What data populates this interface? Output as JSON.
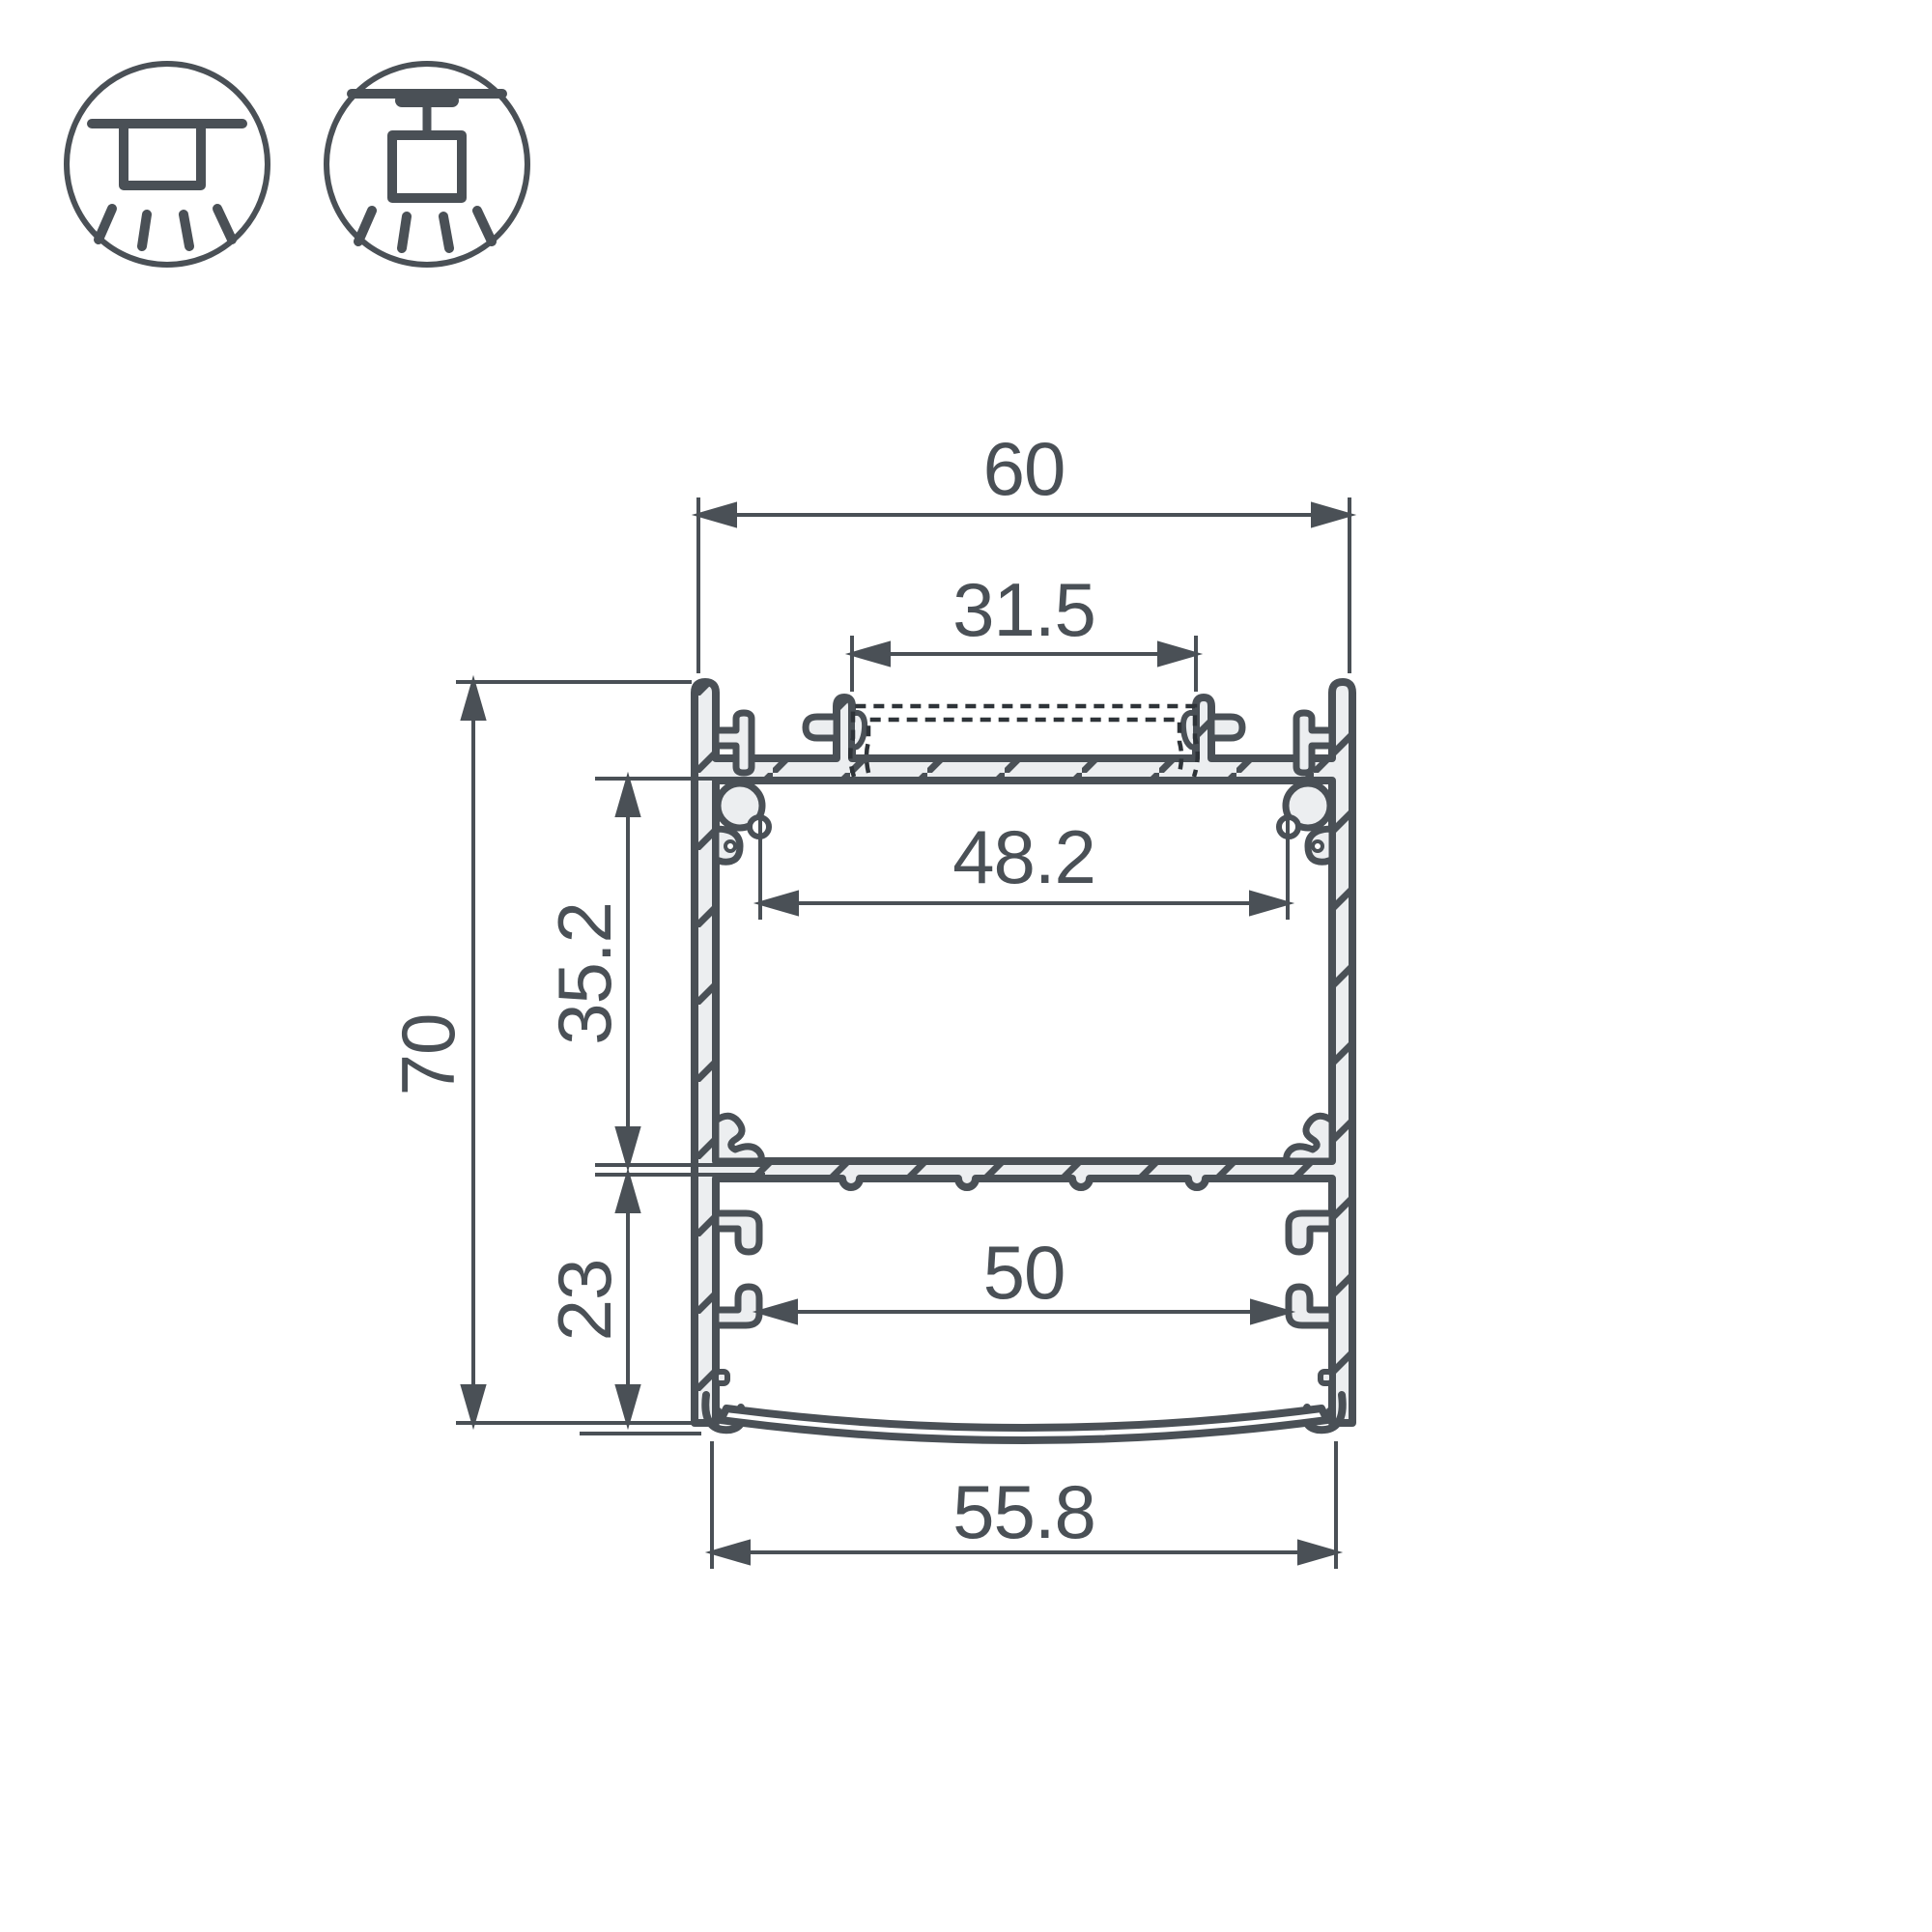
{
  "colors": {
    "line": "#4a5056",
    "aluminum_fill": "#eceef0",
    "background": "#ffffff"
  },
  "icons": {
    "surface_mount": "surface-mount-light-icon",
    "pendant_mount": "pendant-mount-light-icon"
  },
  "dims": {
    "overall_width": "60",
    "top_channel_width": "31.5",
    "inner_width": "48.2",
    "upper_chamber_height": "35.2",
    "overall_height": "70",
    "lower_chamber_height": "23",
    "lower_inner_width": "50",
    "diffuser_width": "55.8"
  }
}
